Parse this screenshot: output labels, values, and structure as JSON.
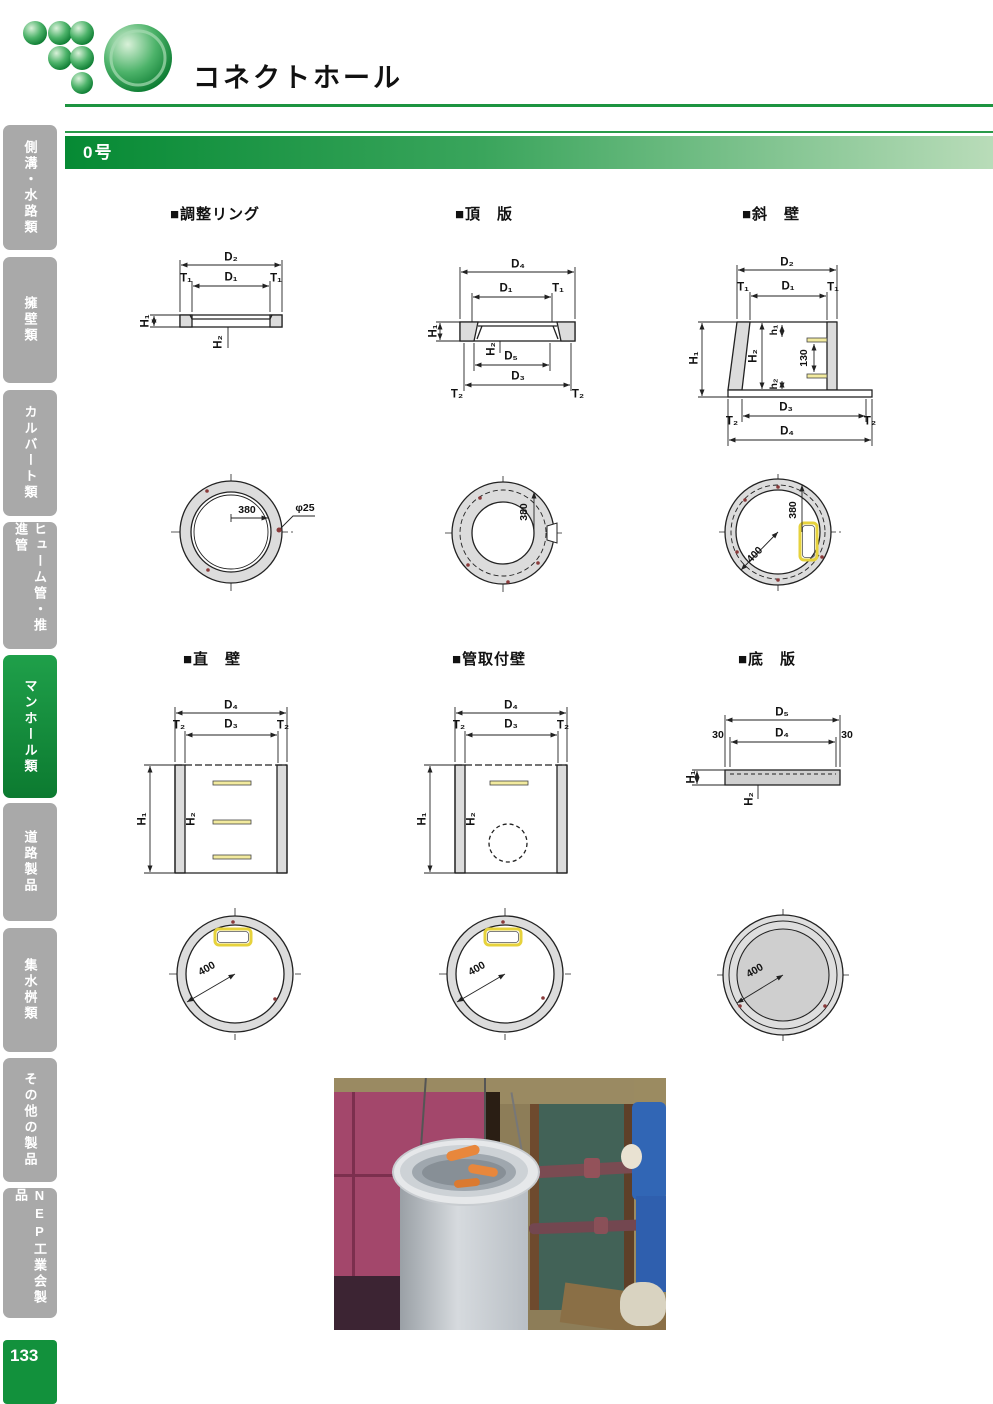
{
  "header": {
    "title": "コネクトホール"
  },
  "section": {
    "label": "0号"
  },
  "sidebar": {
    "tabs": [
      {
        "label": "側溝・水路類",
        "active": false
      },
      {
        "label": "擁壁類",
        "active": false
      },
      {
        "label": "カルバート類",
        "active": false
      },
      {
        "label": "ヒューム管・推進管",
        "active": false
      },
      {
        "label": "マンホール類",
        "active": true
      },
      {
        "label": "道路製品",
        "active": false
      },
      {
        "label": "集水桝類",
        "active": false
      },
      {
        "label": "その他の製品",
        "active": false
      },
      {
        "label": "NEP工業会製品",
        "active": false
      }
    ],
    "page_number": "133"
  },
  "colors": {
    "accent_green": "#12913c",
    "tab_gray": "#a9a9a9",
    "diagram_gray": "#dcdcdc",
    "step_yellow": "#e6d23c",
    "marker_red": "#8a3a3a"
  },
  "diagrams": {
    "adjust_ring": {
      "title": "■調整リング",
      "dims": {
        "d2": "D₂",
        "t1_left": "T₁",
        "d1": "D₁",
        "t1_right": "T₁",
        "h1": "H₁",
        "h2": "H₂"
      },
      "plan": {
        "radius": "380",
        "hole_dia": "φ25"
      }
    },
    "top_slab": {
      "title": "■頂　版",
      "dims": {
        "d4": "D₄",
        "d1": "D₁",
        "t1": "T₁",
        "h1": "H₁",
        "h2": "H₂",
        "d5": "D₅",
        "d3": "D₃",
        "t2_left": "T₂",
        "t2_right": "T₂"
      },
      "plan": {
        "radius_vert": "380"
      }
    },
    "slant_wall": {
      "title": "■斜　壁",
      "dims": {
        "d2": "D₂",
        "t1_left": "T₁",
        "d1": "D₁",
        "t1_right": "T₁",
        "h1": "H₁",
        "h2": "H₂",
        "h1_small": "h₁",
        "h2_small": "h₂",
        "step_pitch": "130",
        "d3": "D₃",
        "t2_left": "T₂",
        "t2_right": "T₂",
        "d4": "D₄"
      },
      "plan": {
        "radius_vert": "380",
        "radius_diag": "400"
      }
    },
    "straight_wall": {
      "title": "■直　壁",
      "dims": {
        "d4": "D₄",
        "t2_left": "T₂",
        "d3": "D₃",
        "t2_right": "T₂",
        "h1": "H₁",
        "h2": "H₂"
      },
      "plan": {
        "radius_diag": "400"
      }
    },
    "pipe_wall": {
      "title": "■管取付壁",
      "dims": {
        "d4": "D₄",
        "t2_left": "T₂",
        "d3": "D₃",
        "t2_right": "T₂",
        "h1": "H₁",
        "h2": "H₂"
      },
      "plan": {
        "radius_diag": "400"
      }
    },
    "bottom_slab": {
      "title": "■底　版",
      "dims": {
        "d5": "D₅",
        "off_left": "30",
        "d4": "D₄",
        "off_right": "30",
        "h1": "H₁",
        "h2": "H₂"
      },
      "plan": {
        "radius_diag": "400"
      }
    }
  }
}
